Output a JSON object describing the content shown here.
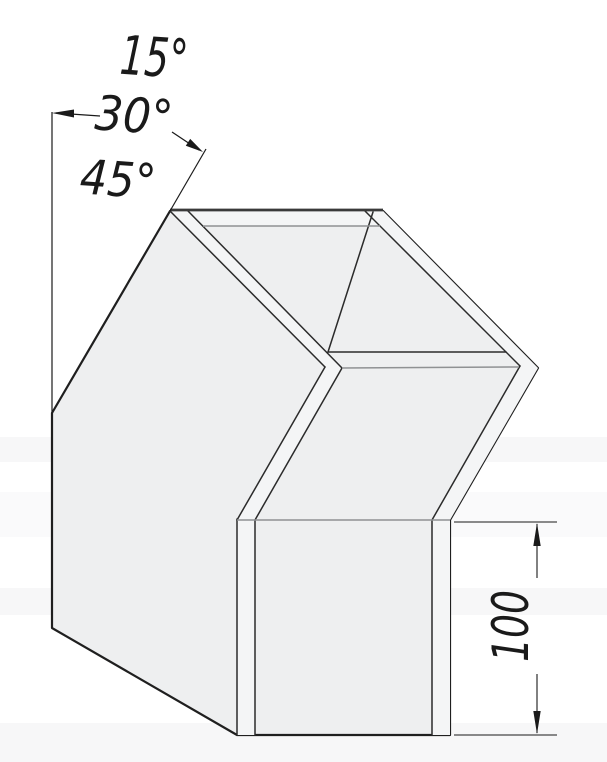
{
  "labels": {
    "angle_1": "15°",
    "angle_2": "30°",
    "angle_3": "45°",
    "height_dim": "100"
  },
  "colors": {
    "background": "#ffffff",
    "face_fill": "#eeeff0",
    "band_fill": "#f4f5f6",
    "outline": "#1f1f1f",
    "inner_edge": "#2b2b2b",
    "gray_edge": "#8f9193",
    "dimension": "#1a1a1a",
    "watermark_band": "#f7f7f8"
  }
}
